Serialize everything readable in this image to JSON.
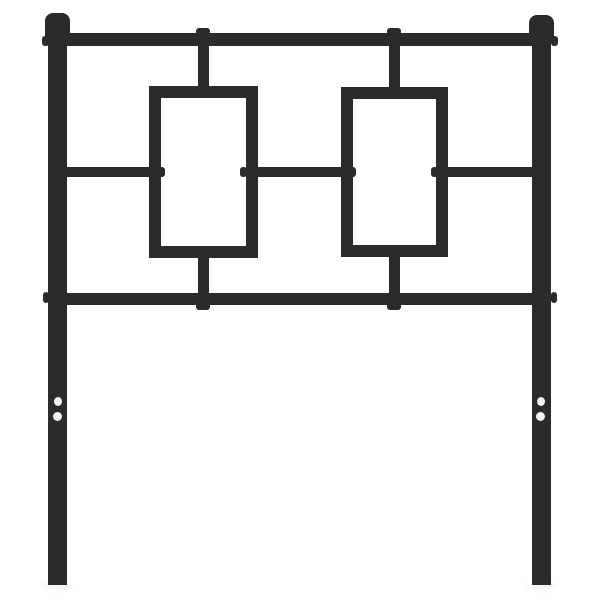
{
  "meta": {
    "subject": "Black metal headboard product photo",
    "canvas": {
      "width": 600,
      "height": 600
    }
  },
  "colors": {
    "metal": "#2b2b2b",
    "background": "#ffffff",
    "hole": "#f2f2f2",
    "shadow": "#e9e9e9"
  },
  "scene": {
    "parts": [
      {
        "name": "left-leg-ground-shadow",
        "type": "shadow",
        "x": 42,
        "y": 583,
        "w": 30,
        "h": 7
      },
      {
        "name": "right-leg-ground-shadow",
        "type": "shadow",
        "x": 526,
        "y": 583,
        "w": 30,
        "h": 7
      },
      {
        "name": "top-rail",
        "type": "bar",
        "x": 58,
        "y": 33,
        "w": 484,
        "h": 13
      },
      {
        "name": "middle-rail-left-segment",
        "type": "bar",
        "x": 60,
        "y": 167,
        "w": 95,
        "h": 10
      },
      {
        "name": "middle-rail-center-segment",
        "type": "bar",
        "x": 252,
        "y": 167,
        "w": 95,
        "h": 10
      },
      {
        "name": "middle-rail-right-segment",
        "type": "bar",
        "x": 444,
        "y": 167,
        "w": 96,
        "h": 10
      },
      {
        "name": "bottom-rail",
        "type": "bar",
        "x": 58,
        "y": 293,
        "w": 484,
        "h": 12
      },
      {
        "name": "left-panel-top-stub",
        "type": "bar",
        "x": 198,
        "y": 44,
        "w": 11,
        "h": 46
      },
      {
        "name": "right-panel-top-stub",
        "type": "bar",
        "x": 389,
        "y": 44,
        "w": 11,
        "h": 47
      },
      {
        "name": "left-panel-bottom-stub",
        "type": "bar",
        "x": 198,
        "y": 253,
        "w": 11,
        "h": 43
      },
      {
        "name": "right-panel-bottom-stub",
        "type": "bar",
        "x": 389,
        "y": 252,
        "w": 11,
        "h": 44
      },
      {
        "name": "weld-nub-top-rail-left",
        "type": "nub",
        "x": 196,
        "y": 28,
        "w": 14,
        "h": 7
      },
      {
        "name": "weld-nub-top-rail-right",
        "type": "nub",
        "x": 387,
        "y": 28,
        "w": 14,
        "h": 7
      },
      {
        "name": "weld-nub-bottom-rail-left",
        "type": "nub",
        "x": 196,
        "y": 302,
        "w": 14,
        "h": 8
      },
      {
        "name": "weld-nub-bottom-rail-right",
        "type": "nub",
        "x": 387,
        "y": 302,
        "w": 14,
        "h": 8
      },
      {
        "name": "weld-nub-left-frame-inner-left",
        "type": "nub",
        "x": 158,
        "y": 167,
        "w": 7,
        "h": 10
      },
      {
        "name": "weld-nub-left-frame-inner-right",
        "type": "nub",
        "x": 240,
        "y": 167,
        "w": 7,
        "h": 10
      },
      {
        "name": "weld-nub-right-frame-inner-left",
        "type": "nub",
        "x": 349,
        "y": 167,
        "w": 7,
        "h": 10
      },
      {
        "name": "weld-nub-right-frame-inner-right",
        "type": "nub",
        "x": 431,
        "y": 167,
        "w": 7,
        "h": 10
      },
      {
        "name": "left-rectangle-frame",
        "type": "frame",
        "x": 149,
        "y": 86,
        "w": 109,
        "h": 172,
        "border": 12
      },
      {
        "name": "right-rectangle-frame",
        "type": "frame",
        "x": 341,
        "y": 87,
        "w": 107,
        "h": 170,
        "border": 12
      },
      {
        "name": "left-post",
        "type": "bar",
        "x": 48,
        "y": 26,
        "w": 19,
        "h": 559
      },
      {
        "name": "right-post",
        "type": "bar",
        "x": 532,
        "y": 26,
        "w": 19,
        "h": 559
      },
      {
        "name": "left-post-cap",
        "type": "bar",
        "x": 45,
        "y": 13,
        "w": 25,
        "h": 28,
        "radius": "8px 8px 2px 2px"
      },
      {
        "name": "right-post-cap",
        "type": "bar",
        "x": 529,
        "y": 15,
        "w": 25,
        "h": 26,
        "radius": "8px 8px 2px 2px"
      },
      {
        "name": "weld-nub-left-post-top",
        "type": "nub",
        "x": 42,
        "y": 36,
        "w": 7,
        "h": 10
      },
      {
        "name": "weld-nub-right-post-top",
        "type": "nub",
        "x": 551,
        "y": 36,
        "w": 7,
        "h": 10
      },
      {
        "name": "weld-nub-left-post-bottom",
        "type": "nub",
        "x": 43,
        "y": 292,
        "w": 6,
        "h": 11
      },
      {
        "name": "weld-nub-right-post-bottom",
        "type": "nub",
        "x": 551,
        "y": 292,
        "w": 6,
        "h": 11
      },
      {
        "name": "left-leg-mount-hole-top",
        "type": "hole",
        "x": 54,
        "y": 397,
        "w": 8,
        "h": 9
      },
      {
        "name": "left-leg-mount-hole-bottom",
        "type": "hole",
        "x": 53,
        "y": 412,
        "w": 9,
        "h": 9
      },
      {
        "name": "right-leg-mount-hole-top",
        "type": "hole",
        "x": 537,
        "y": 397,
        "w": 8,
        "h": 9
      },
      {
        "name": "right-leg-mount-hole-bottom",
        "type": "hole",
        "x": 536,
        "y": 412,
        "w": 9,
        "h": 9
      }
    ]
  }
}
